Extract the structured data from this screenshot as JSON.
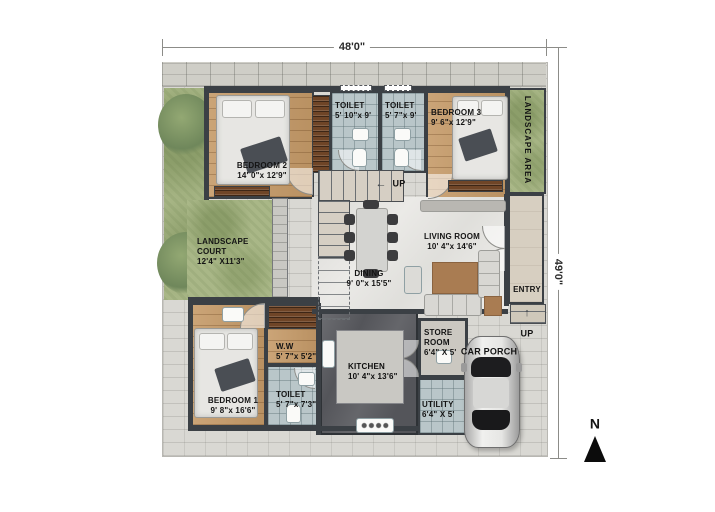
{
  "dims": {
    "width": "48'0\"",
    "height": "49'0\""
  },
  "compass": {
    "label": "N"
  },
  "labels": {
    "up": "UP",
    "arrow_left": "←",
    "arrow_up": "↑"
  },
  "rooms": [
    {
      "id": "bedroom2",
      "name": "BEDROOM 2",
      "size": "14' 0\"x 12'9\""
    },
    {
      "id": "toilet_top_left",
      "name": "TOILET",
      "size": "5' 10\"x 9'"
    },
    {
      "id": "toilet_top_right",
      "name": "TOILET",
      "size": "5' 7\"x 9'"
    },
    {
      "id": "bedroom3",
      "name": "BEDROOM 3",
      "size": "9' 6\"x 12'9\""
    },
    {
      "id": "landscape_area",
      "name": "LANDSCAPE AREA",
      "size": ""
    },
    {
      "id": "landscape_court",
      "name": "LANDSCAPE COURT",
      "size": "12'4\" X11'3\""
    },
    {
      "id": "living_room",
      "name": "LIVING ROOM",
      "size": "10' 4\"x 14'6\""
    },
    {
      "id": "dining",
      "name": "DINING",
      "size": "9' 0\"x 15'5\""
    },
    {
      "id": "entry",
      "name": "ENTRY",
      "size": ""
    },
    {
      "id": "bedroom1",
      "name": "BEDROOM 1",
      "size": "9' 8\"x 16'6\""
    },
    {
      "id": "ww",
      "name": "W.W",
      "size": "5' 7\"x 5'2\""
    },
    {
      "id": "toilet_bottom",
      "name": "TOILET",
      "size": "5' 7\"x 7'3\""
    },
    {
      "id": "kitchen",
      "name": "KITCHEN",
      "size": "10' 4\"x 13'6\""
    },
    {
      "id": "store_room",
      "name": "STORE ROOM",
      "size": "6'4\" X 5'"
    },
    {
      "id": "utility",
      "name": "UTILITY",
      "size": "6'4\" X 5'"
    },
    {
      "id": "car_porch",
      "name": "CAR PORCH",
      "size": ""
    }
  ]
}
